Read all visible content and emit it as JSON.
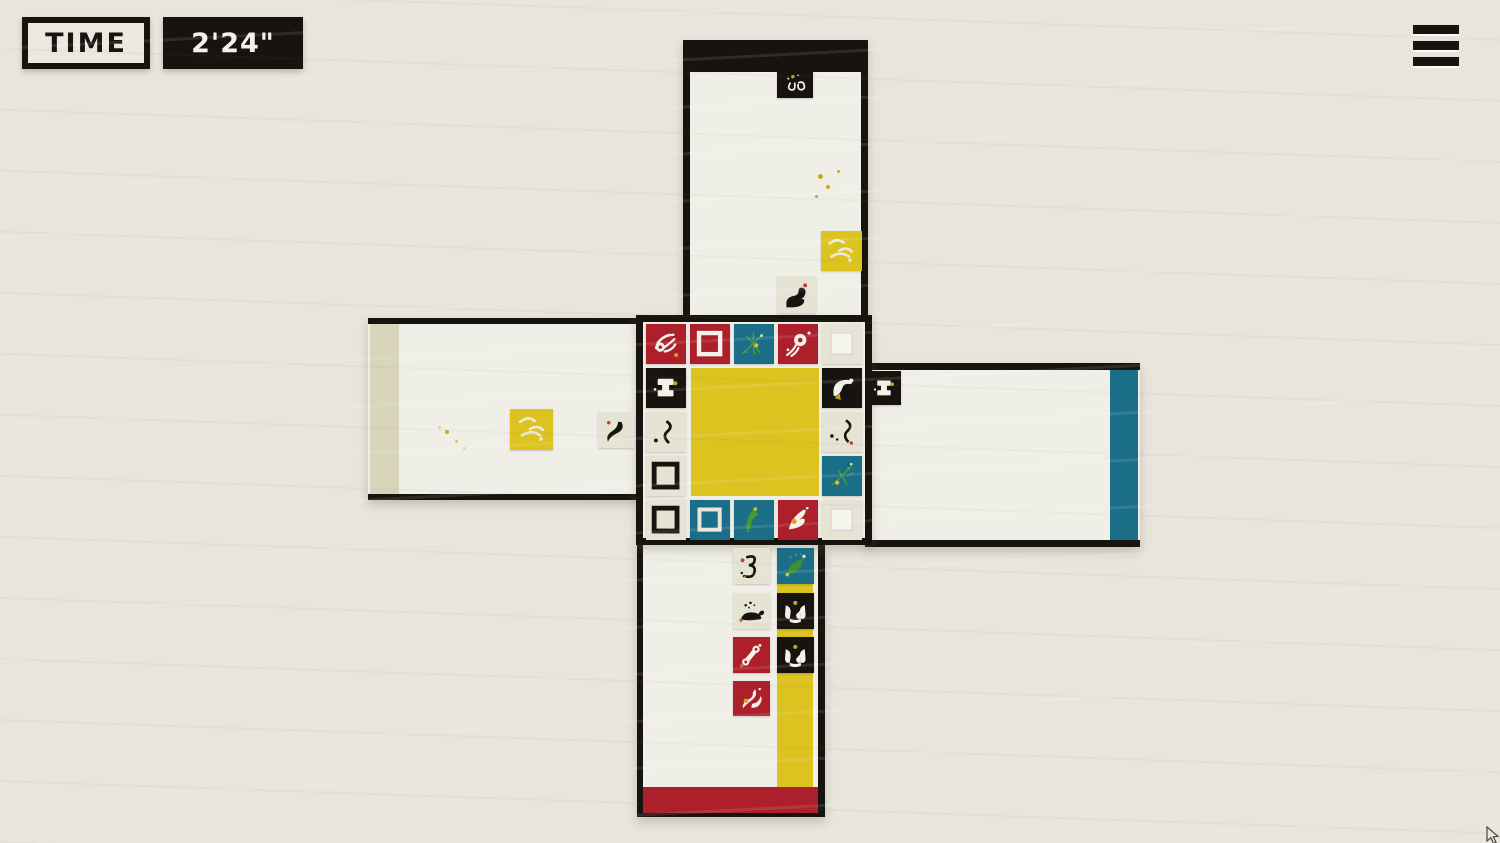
{
  "hud": {
    "time_label": "TIME",
    "time_value": "2'24\""
  },
  "menu": {
    "label": "menu"
  },
  "colors": {
    "bg": "#e7e5dc",
    "board": "#f0efe7",
    "black": "#17140f",
    "red": "#ad1f2b",
    "teal": "#1b6e88",
    "yellow": "#dcc31f",
    "cream": "#e5e3d4",
    "beige": "#d8d5bb"
  },
  "board": {
    "paint_areas": [
      {
        "name": "white-paint-strip",
        "x": 370,
        "y": 324,
        "w": 29,
        "h": 170,
        "color": "beige"
      },
      {
        "name": "teal-paint-strip",
        "x": 1110,
        "y": 370,
        "w": 28,
        "h": 170,
        "color": "teal"
      },
      {
        "name": "center-canvas",
        "x": 691,
        "y": 368,
        "w": 128,
        "h": 128,
        "color": "yellow"
      },
      {
        "name": "yellow-paint-column",
        "x": 777,
        "y": 548,
        "w": 36,
        "h": 240,
        "color": "yellow"
      },
      {
        "name": "red-paint-band",
        "x": 643,
        "y": 787,
        "w": 175,
        "h": 26,
        "color": "red"
      }
    ],
    "tiles": [
      {
        "region": "top-arm",
        "x": 777,
        "y": 68,
        "w": 36,
        "h": 30,
        "color": "black",
        "icon": "curl"
      },
      {
        "region": "top-arm",
        "x": 821,
        "y": 231,
        "w": 41,
        "h": 40,
        "color": "yellow",
        "icon": "paint"
      },
      {
        "region": "top-arm",
        "x": 777,
        "y": 276,
        "w": 39,
        "h": 37,
        "color": "cream",
        "icon": "seal"
      },
      {
        "region": "left-arm",
        "x": 510,
        "y": 409,
        "w": 43,
        "h": 41,
        "color": "yellow",
        "icon": "paint"
      },
      {
        "region": "left-arm",
        "x": 598,
        "y": 412,
        "w": 36,
        "h": 36,
        "color": "cream",
        "icon": "bird2"
      },
      {
        "region": "right-arm",
        "x": 867,
        "y": 371,
        "w": 34,
        "h": 34,
        "color": "black",
        "icon": "spool"
      },
      {
        "region": "center-r0c0",
        "x": 646,
        "y": 324,
        "w": 40,
        "h": 40,
        "color": "red",
        "icon": "hand"
      },
      {
        "region": "center-r0c1",
        "x": 690,
        "y": 324,
        "w": 40,
        "h": 40,
        "color": "red",
        "icon": "square-white"
      },
      {
        "region": "center-r0c2",
        "x": 734,
        "y": 324,
        "w": 40,
        "h": 40,
        "color": "teal",
        "icon": "sparks"
      },
      {
        "region": "center-r0c3",
        "x": 778,
        "y": 324,
        "w": 40,
        "h": 40,
        "color": "red",
        "icon": "comet"
      },
      {
        "region": "center-r0c4",
        "x": 822,
        "y": 324,
        "w": 40,
        "h": 40,
        "color": "cream",
        "icon": "square-soft"
      },
      {
        "region": "center-r1c0",
        "x": 646,
        "y": 368,
        "w": 40,
        "h": 40,
        "color": "black",
        "icon": "spool"
      },
      {
        "region": "center-r1c4",
        "x": 822,
        "y": 368,
        "w": 40,
        "h": 40,
        "color": "black",
        "icon": "bird-dark"
      },
      {
        "region": "center-r2c0",
        "x": 646,
        "y": 412,
        "w": 40,
        "h": 40,
        "color": "cream",
        "icon": "squiggle"
      },
      {
        "region": "center-r2c4",
        "x": 822,
        "y": 412,
        "w": 40,
        "h": 40,
        "color": "cream",
        "icon": "squiggle2"
      },
      {
        "region": "center-r3c0",
        "x": 646,
        "y": 456,
        "w": 40,
        "h": 40,
        "color": "cream",
        "icon": "square-black"
      },
      {
        "region": "center-r3c4",
        "x": 822,
        "y": 456,
        "w": 40,
        "h": 40,
        "color": "teal",
        "icon": "sparks2"
      },
      {
        "region": "center-r4c0",
        "x": 646,
        "y": 500,
        "w": 40,
        "h": 40,
        "color": "cream",
        "icon": "square-black"
      },
      {
        "region": "center-r4c1",
        "x": 690,
        "y": 500,
        "w": 40,
        "h": 40,
        "color": "teal",
        "icon": "square-cream"
      },
      {
        "region": "center-r4c2",
        "x": 734,
        "y": 500,
        "w": 40,
        "h": 40,
        "color": "teal",
        "icon": "bird-green"
      },
      {
        "region": "center-r4c3",
        "x": 778,
        "y": 500,
        "w": 40,
        "h": 40,
        "color": "red",
        "icon": "bird-white"
      },
      {
        "region": "center-r4c4",
        "x": 822,
        "y": 500,
        "w": 40,
        "h": 40,
        "color": "cream",
        "icon": "square-soft"
      },
      {
        "region": "bottom-arm",
        "x": 733,
        "y": 548,
        "w": 37,
        "h": 36,
        "color": "cream",
        "icon": "swirl3"
      },
      {
        "region": "bottom-arm",
        "x": 777,
        "y": 548,
        "w": 37,
        "h": 36,
        "color": "teal",
        "icon": "leaf"
      },
      {
        "region": "bottom-arm",
        "x": 733,
        "y": 593,
        "w": 37,
        "h": 36,
        "color": "cream",
        "icon": "whale"
      },
      {
        "region": "bottom-arm",
        "x": 777,
        "y": 593,
        "w": 37,
        "h": 36,
        "color": "black",
        "icon": "handle"
      },
      {
        "region": "bottom-arm",
        "x": 733,
        "y": 637,
        "w": 37,
        "h": 36,
        "color": "red",
        "icon": "bone"
      },
      {
        "region": "bottom-arm",
        "x": 777,
        "y": 637,
        "w": 37,
        "h": 36,
        "color": "black",
        "icon": "handle"
      },
      {
        "region": "bottom-arm",
        "x": 733,
        "y": 681,
        "w": 37,
        "h": 35,
        "color": "red",
        "icon": "blades"
      }
    ],
    "speckles": [
      {
        "x": 820,
        "y": 176,
        "r": 2.5,
        "color": "#c9a71a"
      },
      {
        "x": 828,
        "y": 187,
        "r": 2,
        "color": "#c9a71a"
      },
      {
        "x": 838,
        "y": 171,
        "r": 1.5,
        "color": "#c9a71a"
      },
      {
        "x": 816,
        "y": 196,
        "r": 1.5,
        "color": "#9aa08e"
      },
      {
        "x": 447,
        "y": 432,
        "r": 2,
        "color": "#c9a71a"
      },
      {
        "x": 456,
        "y": 441,
        "r": 1.5,
        "color": "#d6c65a"
      },
      {
        "x": 464,
        "y": 448,
        "r": 1.5,
        "color": "#ddd3a0"
      },
      {
        "x": 439,
        "y": 427,
        "r": 1.5,
        "color": "#ddd3a0"
      }
    ]
  },
  "cursor": {
    "x": 1486,
    "y": 826
  }
}
